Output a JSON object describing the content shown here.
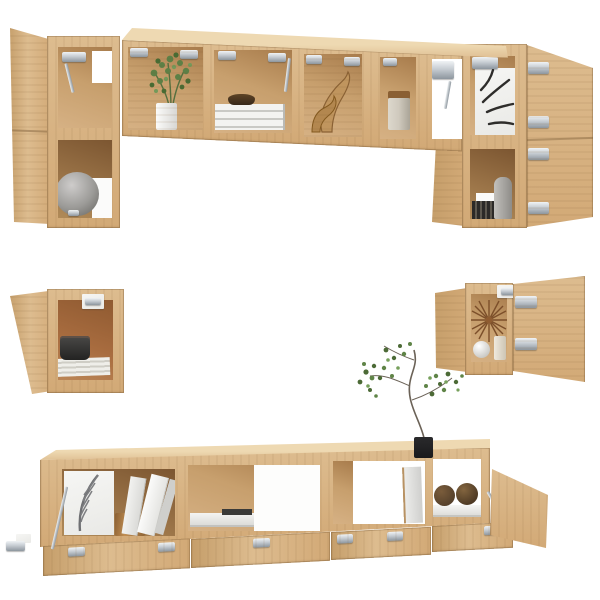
{
  "meta": {
    "description": "Product photo on white background: 6-piece wall-mounted TV entertainment unit in sonoma oak with all doors open showing chrome hinges and styled decor",
    "visible_text": ""
  },
  "colors": {
    "background": "#ffffff",
    "wood_face": "#d2a976",
    "wood_face_light": "#ddbc8f",
    "wood_top": "#eed9b2",
    "wood_side": "#c59e6a",
    "wood_interior": "#c79f6d",
    "wood_interior_dark": "#a87c4c",
    "wood_dark_shadow": "#7c5631",
    "interior_orange": "#a86c3f",
    "hinge_silver": "#c6ccd2",
    "hinge_silver_dark": "#8d969e",
    "white_panel": "#e9e9e6",
    "plant_green": "#5e7f47",
    "plant_green_dark": "#46622f",
    "vase_gray": "#9b9a97",
    "pot_bronze": "#a67b45",
    "ball_brown": "#57422c",
    "pot_black": "#1a1a1c",
    "feather_gray": "#6f7073",
    "leaf_black": "#2e2d2b",
    "canister_beige": "#cfc9bd"
  },
  "scene": {
    "label": "Six-piece sonoma oak wall-mounted TV cabinet set with open doors",
    "pieces": [
      {
        "id": "top-left-wall-cabinet",
        "label": "Tall wall cabinet, two compartments, door open to the left; gray sphere vase on lower shelf"
      },
      {
        "id": "top-horizontal-wall-cabinet",
        "label": "Long horizontal wall cabinet with open flap compartments holding a potted green plant, stacked books with a dark bowl, a carved wooden sculpture and a beige canister"
      },
      {
        "id": "top-right-wall-cabinet",
        "label": "Tall wall cabinet, door open to the right; leaf-print artwork above, gray vase and dark striped box below"
      },
      {
        "id": "middle-left-wall-box",
        "label": "Small square wall cabinet, door open to the left; dark planter on a stack of papers inside"
      },
      {
        "id": "middle-right-wall-box",
        "label": "Small square wall cabinet, door open to the right; rattan sunburst clock, white sphere and candle inside"
      },
      {
        "id": "bottom-tv-cabinet",
        "label": "Low wall-hung TV cabinet with four drop-down doors open; feather-print panel, bronze planter, leaning books, flat book stack, two woven decor balls, black potted tree on top"
      }
    ]
  }
}
